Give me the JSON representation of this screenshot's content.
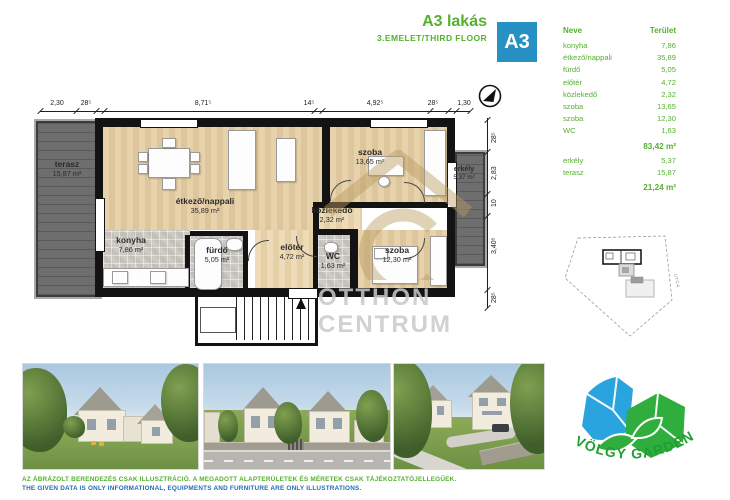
{
  "header": {
    "title": "A3 lakás",
    "subtitle": "3.EMELET/THIRD  FLOOR",
    "badge": "A3"
  },
  "table": {
    "col_name": "Neve",
    "col_area": "Terület",
    "rows": [
      {
        "name": "konyha",
        "area": "7,86"
      },
      {
        "name": "étkező/nappali",
        "area": "35,89"
      },
      {
        "name": "fürdő",
        "area": "5,05"
      },
      {
        "name": "előtér",
        "area": "4,72"
      },
      {
        "name": "közlekedő",
        "area": "2,32"
      },
      {
        "name": "szoba",
        "area": "13,65"
      },
      {
        "name": "szoba",
        "area": "12,30"
      },
      {
        "name": "WC",
        "area": "1,63"
      }
    ],
    "subtotal": "83,42 m²",
    "outdoor_rows": [
      {
        "name": "erkély",
        "area": "5,37"
      },
      {
        "name": "terasz",
        "area": "15,87"
      }
    ],
    "outdoor_total": "21,24 m²"
  },
  "floorplan": {
    "rooms": [
      {
        "name": "terasz",
        "area": "15,87 m²"
      },
      {
        "name": "étkező/nappali",
        "area": "35,89 m²"
      },
      {
        "name": "konyha",
        "area": "7,86 m²"
      },
      {
        "name": "fürdő",
        "area": "5,05 m²"
      },
      {
        "name": "előtér",
        "area": "4,72 m²"
      },
      {
        "name": "közlekedő",
        "area": "2,32 m²"
      },
      {
        "name": "WC",
        "area": "1,63 m²"
      },
      {
        "name": "szoba",
        "area": "13,65 m²"
      },
      {
        "name": "szoba",
        "area": "12,30 m²"
      },
      {
        "name": "erkély",
        "area": "5,37 m²"
      }
    ],
    "dims_top": [
      "2,30",
      "28⁵",
      "8,71⁵",
      "14⁵",
      "4,92⁵",
      "28⁵",
      "1,30"
    ],
    "dims_right": [
      "28⁵",
      "2,83",
      "10",
      "3,40⁵",
      "28⁵"
    ],
    "watermark": {
      "line1": "OTTHON",
      "line2": "CENTRUM"
    }
  },
  "site_plan": {
    "street_label": "UTCA"
  },
  "logo": {
    "text": "VÖLGY GARDEN"
  },
  "disclaimer": {
    "line1_hu": "AZ ÁBRÁZOLT BERENDEZÉS CSAK ILLUSZTRÁCIÓ. A MEGADOTT ALAPTERÜLETEK ÉS MÉRETEK CSAK TÁJÉKOZTATÓJELLEGŰEK.",
    "line2_en": "THE GIVEN DATA IS ONLY INFORMATIONAL, EQUIPMENTS AND FURNITURE ARE ONLY ILLUSTRATIONS."
  },
  "colors": {
    "green": "#55b02f",
    "badge_blue": "#2791c3",
    "text_blue": "#1f6cb5",
    "logo_blue": "#2aa4de",
    "logo_green": "#2fae3e",
    "wall_black": "#131313"
  }
}
